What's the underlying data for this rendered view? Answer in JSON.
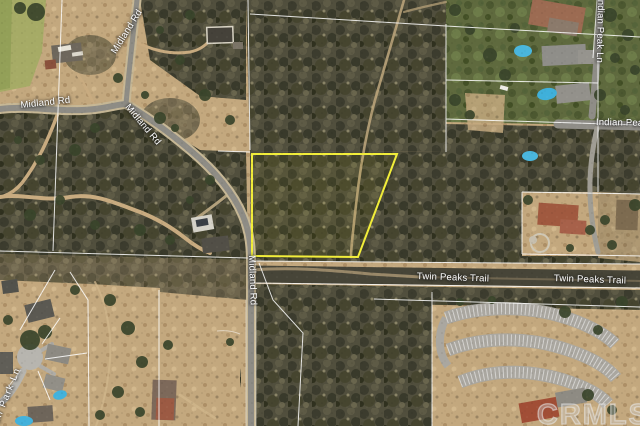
{
  "map": {
    "type": "satellite-aerial",
    "watermark": "CRMLS",
    "colors": {
      "parcel_outline": "#f2ee3a",
      "road_label_text": "#ffffff"
    },
    "road_labels": {
      "midland_rd_west": "Midland Rd",
      "midland_rd_north": "Midland Rd",
      "midland_rd_curve": "Midland Rd",
      "midland_rd_south": "Midland Rd",
      "twin_peaks_trail_west": "Twin Peaks Trail",
      "twin_peaks_trail_east": "Twin Peaks Trail",
      "indian_peak_ln_vertical": "Indian Peak Ln",
      "indian_peak_ln_horizontal": "Indian Peak Ln",
      "ball_park_ln": "Ball Park Ln"
    }
  }
}
